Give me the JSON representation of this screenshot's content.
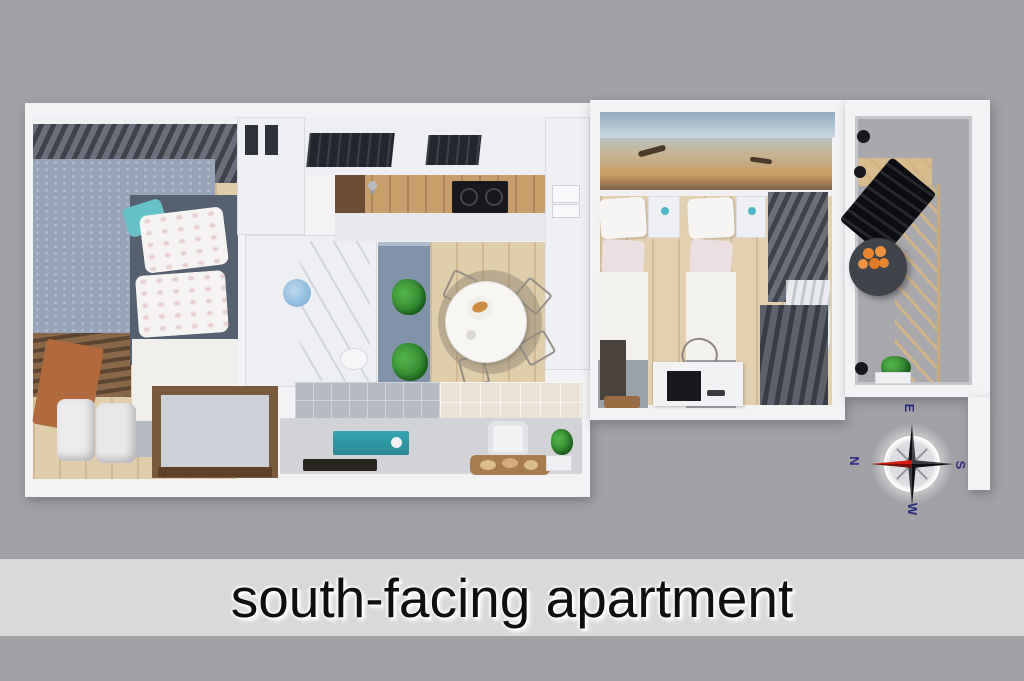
{
  "scene": {
    "type": "3d-floor-plan-top-view",
    "name": "apartment-floor-plan"
  },
  "caption": {
    "text": "south-facing apartment"
  },
  "compass": {
    "north_label": "N",
    "east_label": "E",
    "south_label": "S",
    "west_label": "W"
  },
  "rooms": [
    {
      "name": "bedroom-1"
    },
    {
      "name": "bathroom"
    },
    {
      "name": "kitchen"
    },
    {
      "name": "dining-area"
    },
    {
      "name": "bedroom-2"
    },
    {
      "name": "balcony"
    }
  ],
  "colors": {
    "background": "#a2a1a6",
    "caption_bar": "#d9d9d9",
    "caption_text": "#0f0f0f",
    "walls": "#f3f3f6",
    "wood_floor": "#e0cda9",
    "wallpaper_blue": "#96a3b8",
    "accent_teal": "#2f9dac",
    "compass_north_needle": "#d01d10",
    "compass_needle": "#0f1013",
    "compass_label": "#2c2a80"
  }
}
